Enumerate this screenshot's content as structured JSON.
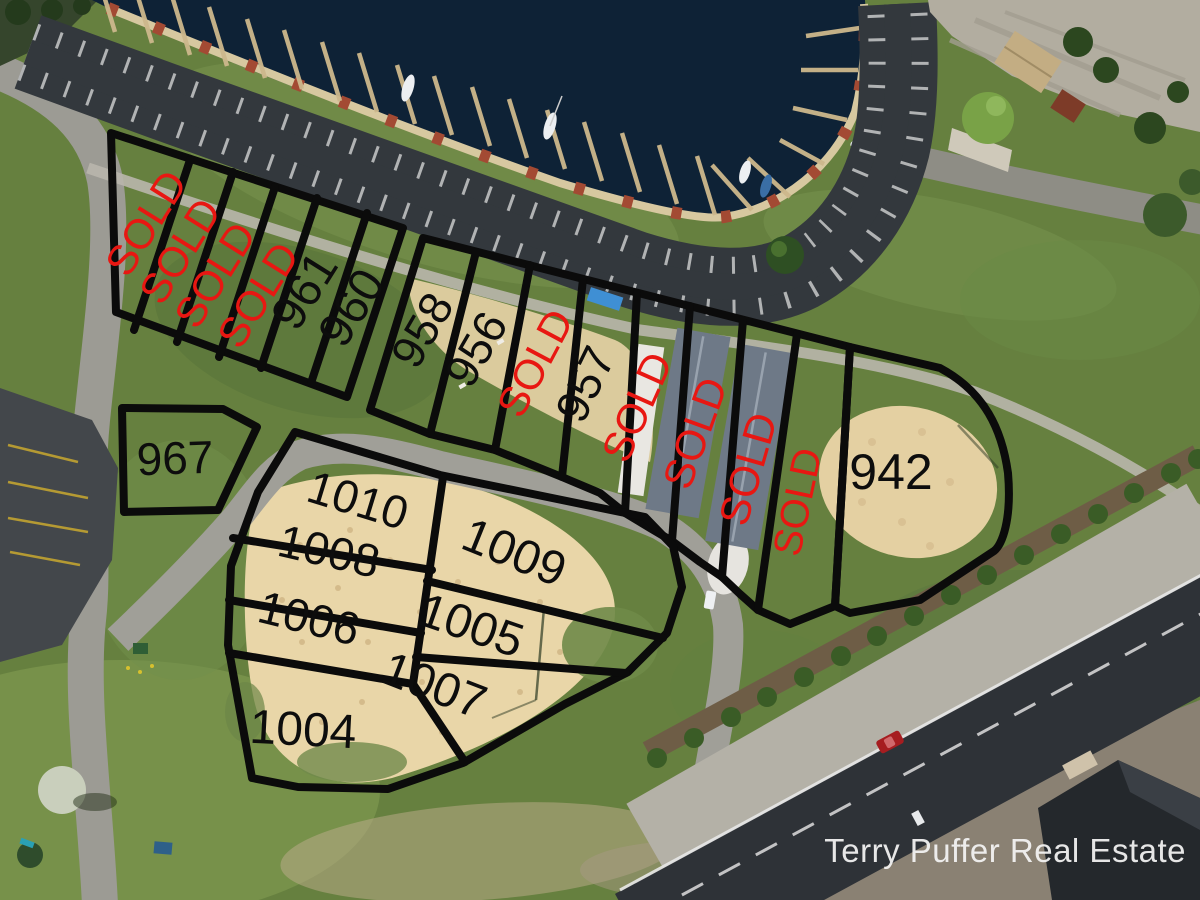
{
  "watermark": {
    "text": "Terry Puffer Real Estate"
  },
  "lots": [
    {
      "label": "SOLD"
    },
    {
      "label": "SOLD"
    },
    {
      "label": "SOLD"
    },
    {
      "label": "SOLD"
    },
    {
      "label": "961"
    },
    {
      "label": "960"
    },
    {
      "label": "958"
    },
    {
      "label": "956"
    },
    {
      "label": "SOLD"
    },
    {
      "label": "957"
    },
    {
      "label": "SOLD"
    },
    {
      "label": "SOLD"
    },
    {
      "label": "SOLD"
    },
    {
      "label": "SOLD"
    },
    {
      "label": "942"
    },
    {
      "label": "967"
    },
    {
      "label": "1010"
    },
    {
      "label": "1008"
    },
    {
      "label": "1006"
    },
    {
      "label": "1004"
    },
    {
      "label": "1009"
    },
    {
      "label": "1005"
    },
    {
      "label": "1007"
    }
  ],
  "colors": {
    "sold_red": "#e81712",
    "lot_number_black": "#0d0d0d",
    "lot_outline_black": "#0b0b0b",
    "water_navy": "#0e2236",
    "grass_green": "#66803f",
    "sand_tan": "#e9d6a8",
    "asphalt_dark": "#33383d",
    "road_gray": "#9c9b94",
    "watermark_white": "#f5f5f5"
  }
}
